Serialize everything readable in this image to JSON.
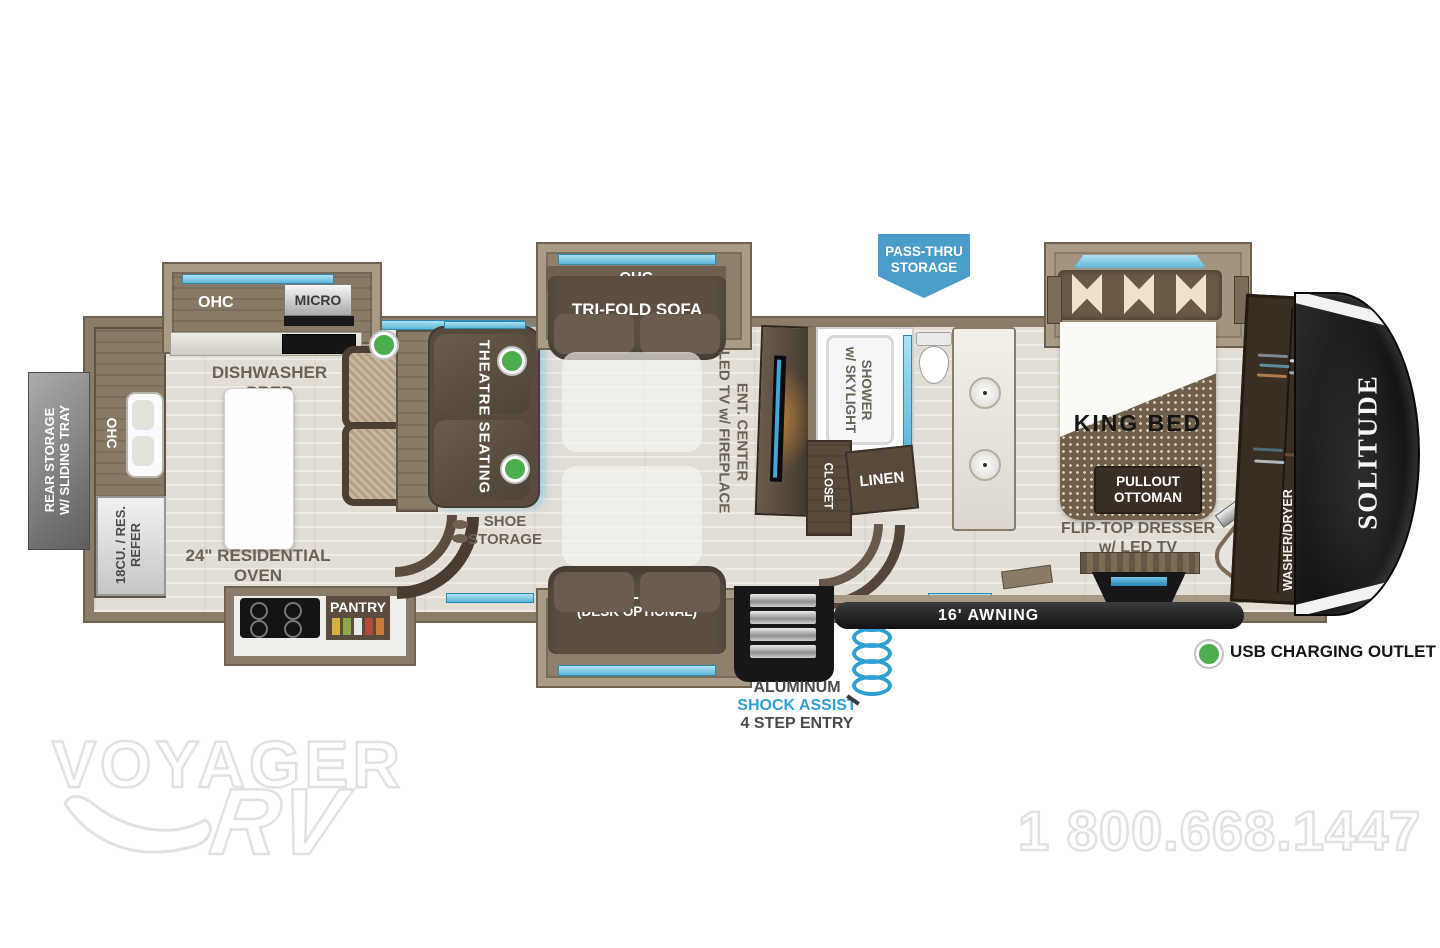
{
  "labels": {
    "rear_storage_l1": "REAR STORAGE",
    "rear_storage_l2": "W/ SLIDING TRAY",
    "rear_ohc": "OHC",
    "refer_l1": "18CU. / RES.",
    "refer_l2": "REFER",
    "kitchen_ohc": "OHC",
    "micro": "MICRO",
    "dishwasher_l1": "DISHWASHER",
    "dishwasher_l2": "PREP",
    "oven_l1": "24\" RESIDENTIAL",
    "oven_l2": "OVEN",
    "pantry": "PANTRY",
    "theatre": "THEATRE SEATING",
    "sofa_top_ohc": "OHC",
    "sofa_top": "TRI-FOLD SOFA",
    "sofa_bottom_l1": "TRI-FOLD SOFA",
    "sofa_bottom_l2": "(DESK OPTIONAL)",
    "shoe_l1": "SHOE",
    "shoe_l2": "STORAGE",
    "ent_l1": "ENT. CENTER",
    "ent_l2": "LED TV w/ FIREPLACE",
    "shower_l1": "SHOWER",
    "shower_l2": "w/ SKYLIGHT",
    "closet": "CLOSET",
    "linen": "LINEN",
    "pass_thru_l1": "PASS-THRU",
    "pass_thru_l2": "STORAGE",
    "king_bed": "KING BED",
    "ottoman_l1": "PULLOUT",
    "ottoman_l2": "OTTOMAN",
    "dresser_l1": "FLIP-TOP DRESSER",
    "dresser_l2": "w/ LED TV",
    "washer_l1": "WASHER/DRYER",
    "washer_l2": "PREP",
    "brand": "SOLITUDE",
    "awning": "16' AWNING",
    "entry_l1": "ALUMINUM",
    "entry_l2": "SHOCK ASSIST",
    "entry_l3": "4 STEP ENTRY"
  },
  "legend": {
    "usb": "USB CHARGING OUTLET"
  },
  "watermark": {
    "dealer_l1": "VOYAGER",
    "dealer_l2": "RV",
    "phone": "1 800.668.1447"
  },
  "colors": {
    "wall": "#8a7c69",
    "slide_trim": "#a89a84",
    "floor": "#e2ded6",
    "window_blue": "#7ecbe8",
    "banner_blue": "#4a9dc8",
    "usb_green": "#4cae4f",
    "label_gray": "#6b6257",
    "shock_blue": "#2f9fd6",
    "furniture_brown": "#5c4f42",
    "cap_black": "#141416"
  }
}
